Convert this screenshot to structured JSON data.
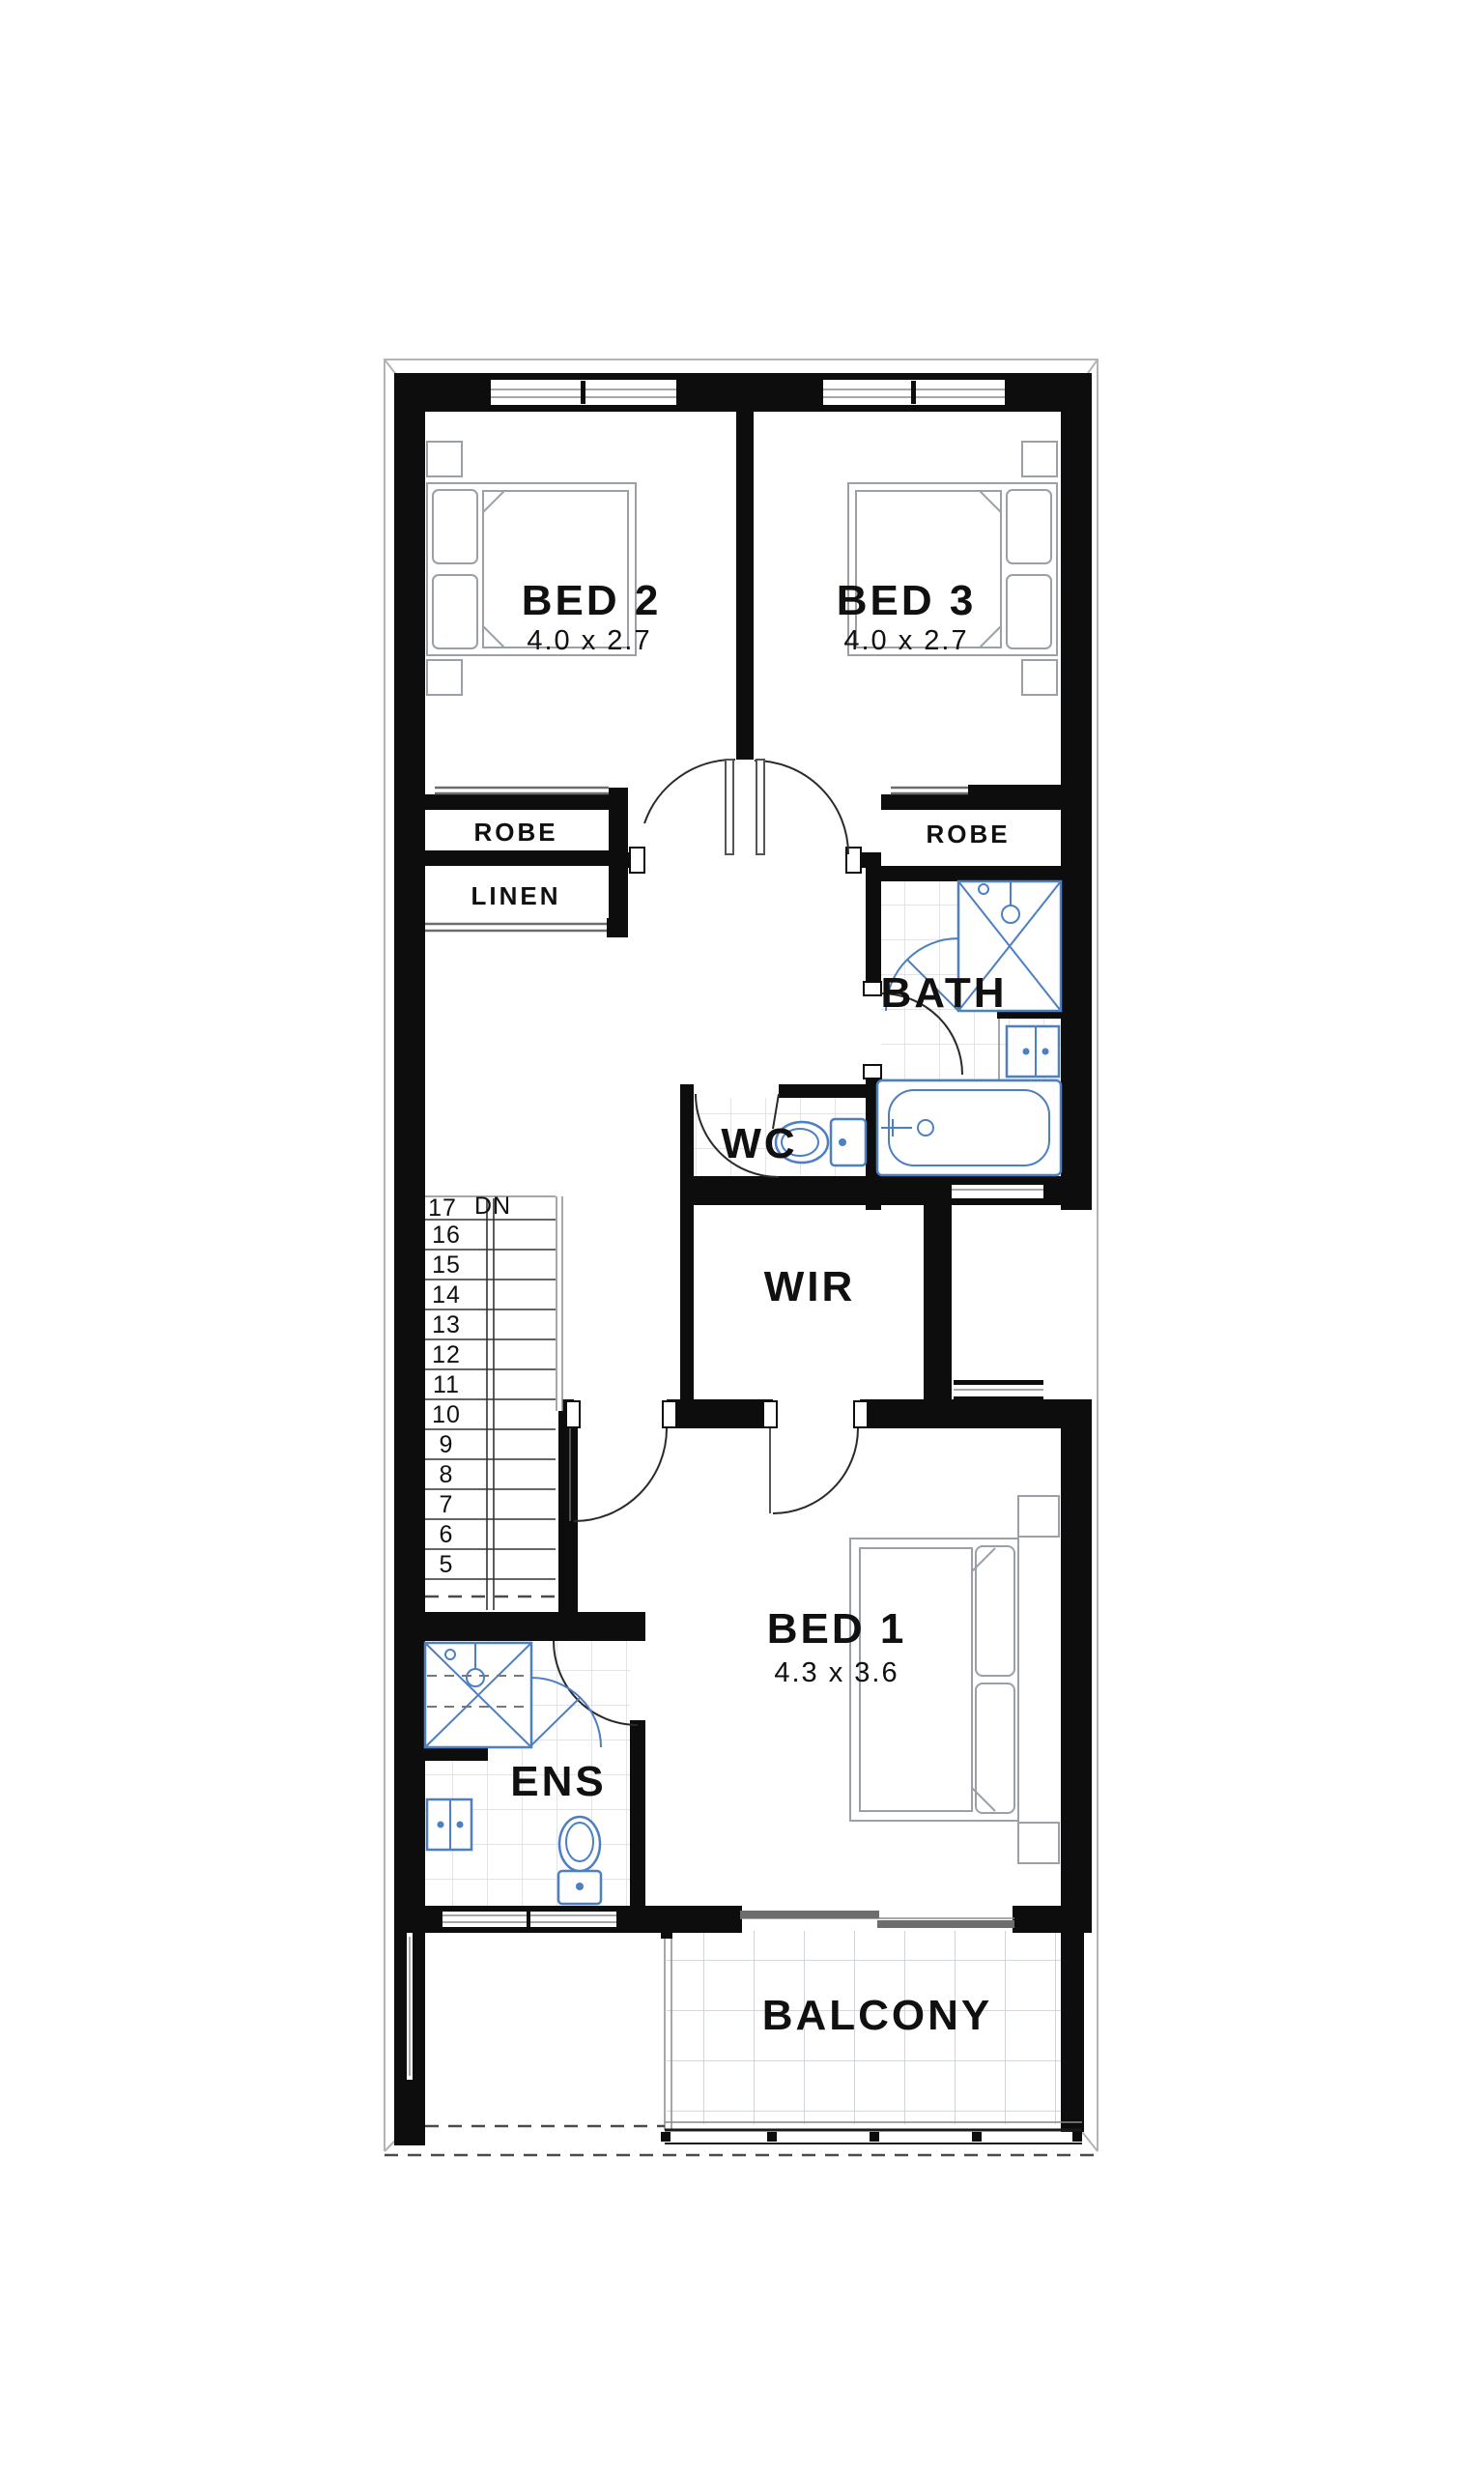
{
  "plan": {
    "type": "floor-plan-upper-storey",
    "colors": {
      "wall": "#0d0d0d",
      "fixture_blue": "#4d7fc4",
      "furniture_gray": "#9aa0a6",
      "tile_gray": "#d8dce1",
      "label_text": "#101010"
    },
    "rooms": {
      "bed2": {
        "label": "BED 2",
        "dims": "4.0 x 2.7"
      },
      "bed3": {
        "label": "BED 3",
        "dims": "4.0 x 2.7"
      },
      "bed1": {
        "label": "BED 1",
        "dims": "4.3 x 3.6"
      },
      "robe_left": {
        "label": "ROBE"
      },
      "robe_right": {
        "label": "ROBE"
      },
      "linen": {
        "label": "LINEN"
      },
      "bath": {
        "label": "BATH"
      },
      "wc": {
        "label": "WC"
      },
      "wir": {
        "label": "WIR"
      },
      "ens": {
        "label": "ENS"
      },
      "balcony": {
        "label": "BALCONY"
      }
    },
    "stairs": {
      "top_tread": "17",
      "direction": "DN",
      "numbers": [
        "16",
        "15",
        "14",
        "13",
        "12",
        "11",
        "10",
        "9",
        "8",
        "7",
        "6",
        "5"
      ]
    }
  }
}
